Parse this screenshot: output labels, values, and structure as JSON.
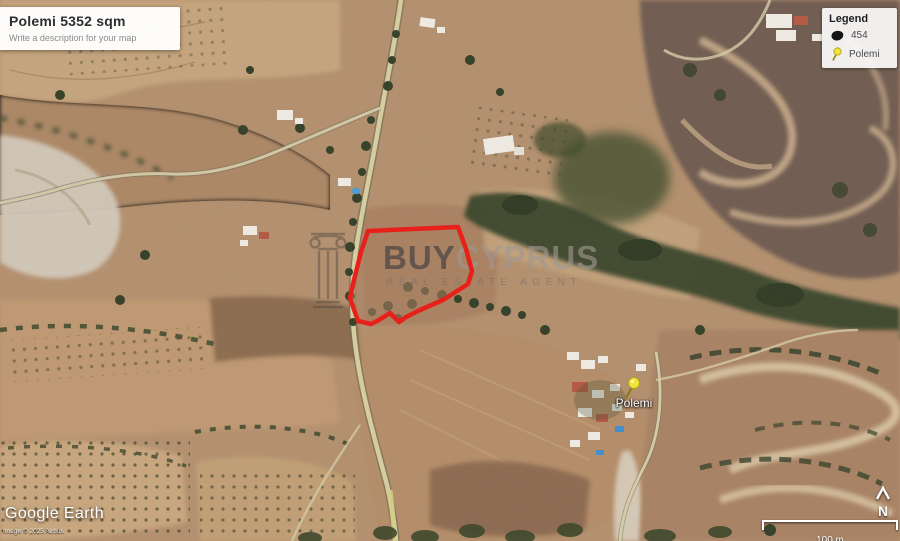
{
  "title_card": {
    "title": "Polemi 5352 sqm",
    "subtitle": "Write a description for your map"
  },
  "legend": {
    "title": "Legend",
    "items": [
      {
        "label": "454",
        "icon": "parcel-polygon-swatch",
        "color": "#141414"
      },
      {
        "label": "Polemi",
        "icon": "pushpin",
        "color": "#f0e53a"
      }
    ]
  },
  "parcel": {
    "outline_color": "#e8201a"
  },
  "placemark": {
    "label": "Polemi",
    "pin_color": "#f0e53a"
  },
  "watermark": {
    "brand_bold": "BUY",
    "brand_light": "CYPRUS",
    "tagline": "REAL ESTATE AGENT"
  },
  "attribution": {
    "logo": "Google Earth",
    "copyright": "Image © 2025 Airbus"
  },
  "scale_bar": {
    "label": "100 m"
  },
  "compass": {
    "label": "N"
  }
}
